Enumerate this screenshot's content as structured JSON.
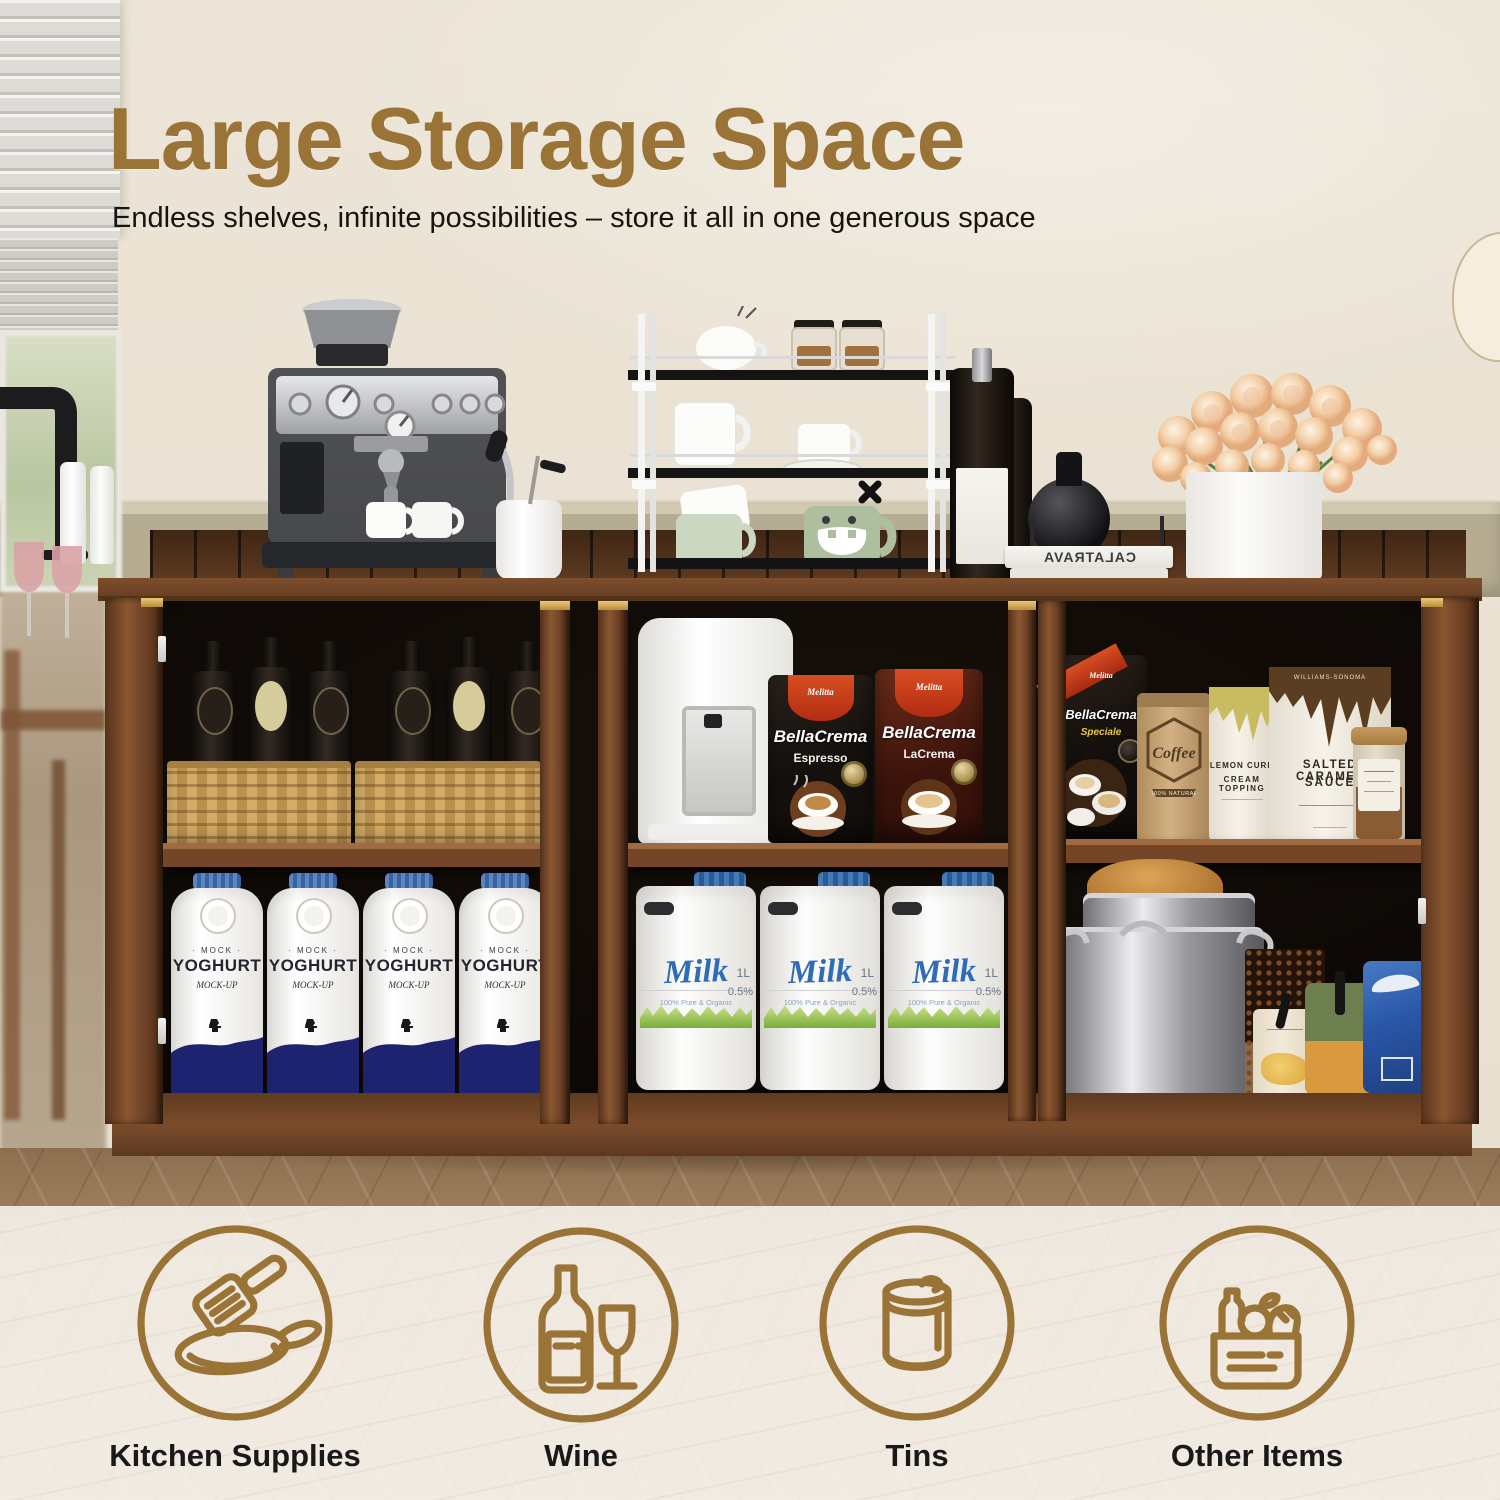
{
  "header": {
    "title": "Large Storage Space",
    "subtitle": "Endless shelves, infinite possibilities – store it all in one generous space"
  },
  "categories": [
    {
      "label": "Kitchen Supplies"
    },
    {
      "label": "Wine"
    },
    {
      "label": "Tins"
    },
    {
      "label": "Other Items"
    }
  ],
  "products": {
    "yoghurt": {
      "brand": "· MOCK ·",
      "name": "YOGHURT",
      "sub": "MOCK-UP"
    },
    "milk": {
      "name": "Milk",
      "tagline": "100% Pure & Organic",
      "size": "1L",
      "fat": "0.5%"
    },
    "espresso_bag": {
      "brand": "Melitta",
      "name": "BellaCrema",
      "variant": "Espresso"
    },
    "lacrema_bag": {
      "brand": "Melitta",
      "name": "BellaCrema",
      "variant": "LaCrema"
    },
    "speciale_bag": {
      "brand": "Melitta",
      "name": "BellaCrema",
      "variant": "Speciale"
    },
    "kraft_bag": {
      "name": "Coffee",
      "tagline": "100% NATURAL"
    },
    "lemon_bag": {
      "line1": "LEMON CURD",
      "line2": "CREAM TOPPING"
    },
    "caramel_bag": {
      "brand": "WILLIAMS-SONOMA",
      "line1": "SALTED CARAMEL",
      "line2": "SAUCE"
    },
    "beans_box": {
      "code": "43ESUD"
    },
    "book": {
      "spine": "CALATRAVA"
    }
  },
  "colors": {
    "accent": "#9a7336",
    "wall": "#eae3d5",
    "cabinet_wood": "#7a4b2c",
    "yoghurt_navy": "#1e2370",
    "milk_blue": "#2f6cb5",
    "melitta_red": "#c0391b"
  }
}
